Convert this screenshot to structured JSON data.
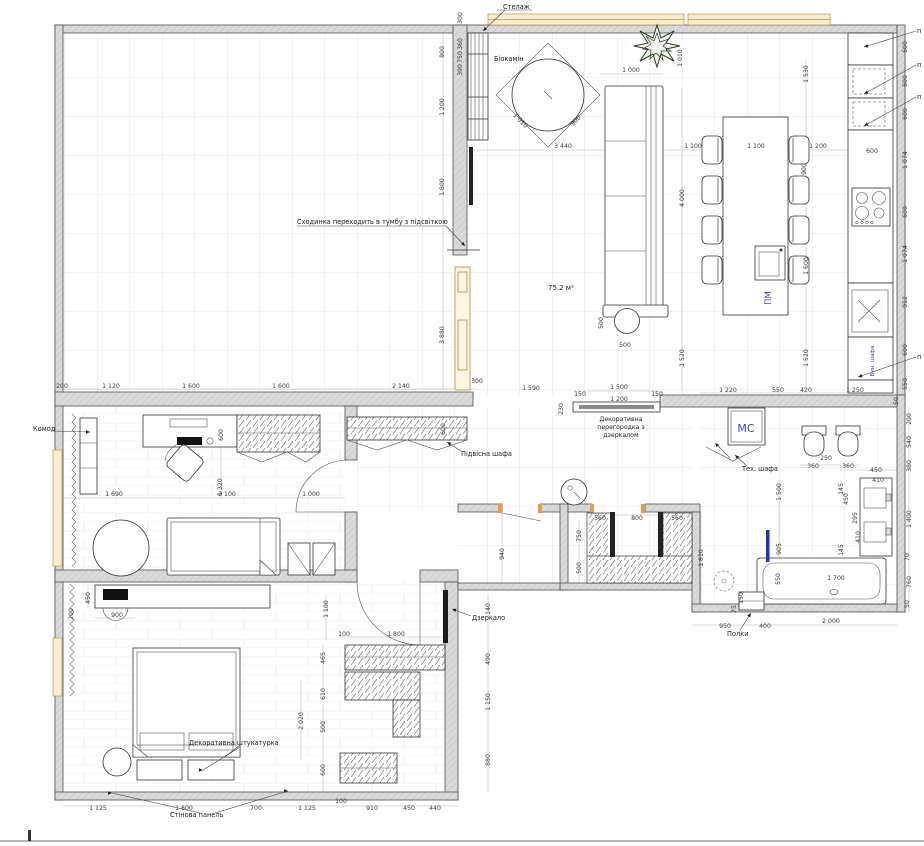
{
  "labels": {
    "stelazh": "Стелаж",
    "biokamin": "Біокамін",
    "skhodynka": "Сходинка переходить в тумбу з підсвіткою",
    "area": "75.2 м²",
    "pm": "ПМ",
    "komod": "Комод",
    "pidvisna": "Підвісна шафа",
    "part1": "Декоративна",
    "part2": "перегородка з",
    "part3": "дзеркалом",
    "mc": "МС",
    "tekh": "Тех. шафа",
    "dzerkalo": "Дзеркало",
    "shtukaturka": "Декоративна штукатурка",
    "panel": "Стінова панель",
    "polky": "Полки",
    "vyn": "Вин. шафа",
    "cut": "п"
  },
  "colors": {
    "accent_blue": "#3a46c8",
    "wall_gray": "#d9d9d9",
    "window_tan": "#c09040"
  },
  "dims": {
    "shelf_top": "300",
    "shelf_a": "360",
    "shelf_b": "750",
    "shelf_c": "390",
    "lchain_a": "800",
    "lchain_b": "1 200",
    "lchain_c": "1 800",
    "lchain_d": "3 880",
    "lchain_e": "300",
    "sofa_w": "1 000",
    "plant_h": "1 010",
    "liv_3440": "3 440",
    "fire_a": "1 010",
    "fire_b": "900",
    "tbl_a": "1 100",
    "tbl_b": "1 100",
    "tbl_c": "1 200",
    "tbl_d": "1 530",
    "tbl_e": "900",
    "sofa_l": "4 000",
    "isl_a": "1 600",
    "isl_b": "1 520",
    "isl_c": "1 520",
    "ott_a": "500",
    "ott_b": "500",
    "kr_a": "600",
    "kr_b": "600",
    "kr_c": "600",
    "kr_d": "1 074",
    "kr_e": "600",
    "kr_f": "1 074",
    "kr_g": "912",
    "kr_h": "600",
    "kr_i": "550",
    "kr_j": "600",
    "kr_k": "1 250",
    "mid_a": "200",
    "mid_b": "1 120",
    "mid_c": "1 600",
    "mid_d": "1 600",
    "mid_e": "2 140",
    "mid_f": "1 590",
    "par_a": "150",
    "par_b": "1 500",
    "par_c": "150",
    "par_d": "1 200",
    "par_e": "230",
    "mid_g": "1 220",
    "mid_h": "550",
    "mid_i": "420",
    "mid_j": "50",
    "br_a": "200",
    "br_b": "540",
    "br_c": "380",
    "br_d": "1 400",
    "br_e": "70",
    "br_f": "760",
    "br_g": "50",
    "wc_a": "360",
    "wc_b": "250",
    "wc_c": "360",
    "wb_a": "450",
    "wb_b": "410",
    "wb_c": "145",
    "wb_d": "450",
    "wb_e": "295",
    "wb_f": "410",
    "wb_g": "145",
    "tub_a": "1 700",
    "tub_b": "2 000",
    "cl_a": "560",
    "cl_b": "800",
    "cl_c": "560",
    "cl_d": "750",
    "cl_e": "500",
    "cl_f": "1 810",
    "cr_a": "1 500",
    "cr_b": "905",
    "cr_c": "550",
    "cr_d": "150",
    "cr_e": "75",
    "cb_a": "950",
    "cb_b": "400",
    "hall_940": "940",
    "st_600": "600",
    "st_a": "1 690",
    "st_b": "2 100",
    "st_c": "1 000",
    "st_d": "1 320",
    "van_a": "450",
    "van_b": "200",
    "van_c": "900",
    "bw_1100": "1 100",
    "bw_100": "100",
    "bw_1800": "1 800",
    "bw_a": "465",
    "bw_b": "610",
    "bw_c": "500",
    "bw_d": "600",
    "br2_a": "140",
    "br2_b": "490",
    "br2_c": "1 150",
    "br2_d": "880",
    "bed_2020": "2 020",
    "bot_a": "1 125",
    "bot_b": "1 800",
    "bot_c": "700",
    "bot_d": "1 125",
    "bot_e": "100",
    "bot_f": "910",
    "bot_g": "450",
    "bot_h": "440",
    "hw_600": "600"
  }
}
